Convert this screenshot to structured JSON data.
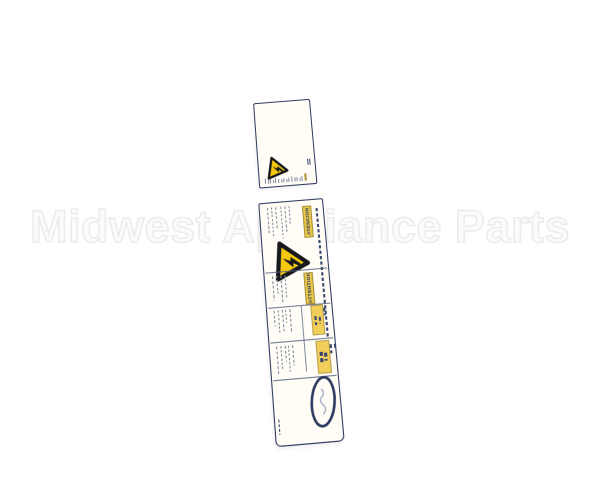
{
  "photo": {
    "background": "#ffffff"
  },
  "watermark": {
    "text": "Midwest Appliance Parts"
  },
  "label": {
    "colors": {
      "navy": "#2e3a60",
      "ink": "#39466e",
      "micro": "#7d86a0",
      "warning_yellow": "#f5c80f",
      "banner_yellow": "#e9c74b",
      "hl_yellow": "#f2cf5a",
      "paper": "#fffdf6"
    },
    "top_panel": {
      "icon": "electric-shock-warning-triangle-icon"
    },
    "main_panel": {
      "icon": "electric-shock-warning-triangle-icon",
      "banners": [
        {
          "text": "ATENCION"
        },
        {
          "text": "ATTENTION"
        }
      ],
      "logo": "brand-oval-stamp"
    }
  }
}
